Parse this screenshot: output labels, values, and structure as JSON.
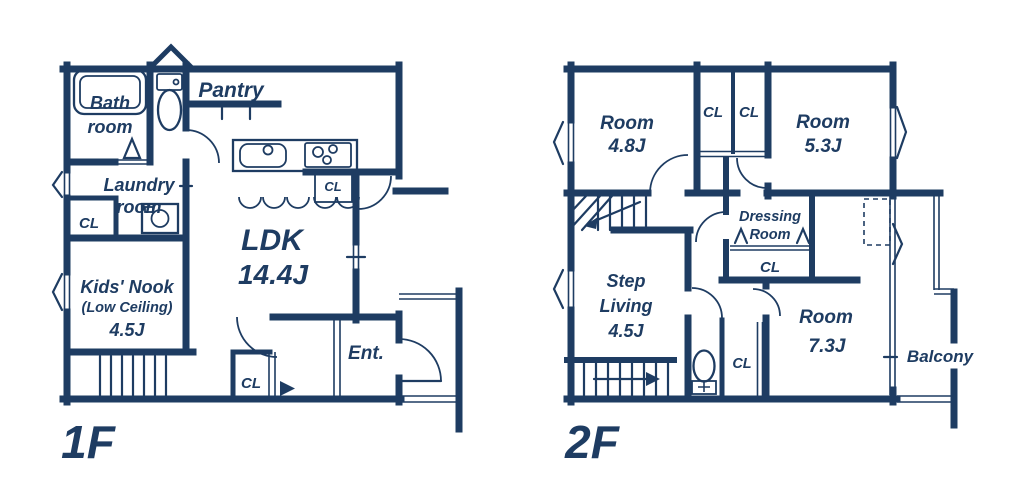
{
  "colors": {
    "ink": "#1e3c62",
    "paper": "#ffffff"
  },
  "floor1": {
    "label": "1F",
    "bathroom_line1": "Bath",
    "bathroom_line2": "room",
    "pantry": "Pantry",
    "laundry_line1": "Laundry",
    "laundry_line2": "room",
    "laundry_cl": "CL",
    "kitchen_cl": "CL",
    "ldk_name": "LDK",
    "ldk_size": "14.4J",
    "kids_line1": "Kids' Nook",
    "kids_line2": "(Low Ceiling)",
    "kids_line3": "4.5J",
    "hall_cl": "CL",
    "entrance": "Ent."
  },
  "floor2": {
    "label": "2F",
    "room48_name": "Room",
    "room48_size": "4.8J",
    "cl_a": "CL",
    "cl_b": "CL",
    "room53_name": "Room",
    "room53_size": "5.3J",
    "dressing_line1": "Dressing",
    "dressing_line2": "Room",
    "dressing_cl": "CL",
    "step_line1": "Step",
    "step_line2": "Living",
    "step_line3": "4.5J",
    "wc_cl": "CL",
    "room73_name": "Room",
    "room73_size": "7.3J",
    "balcony": "Balcony"
  }
}
